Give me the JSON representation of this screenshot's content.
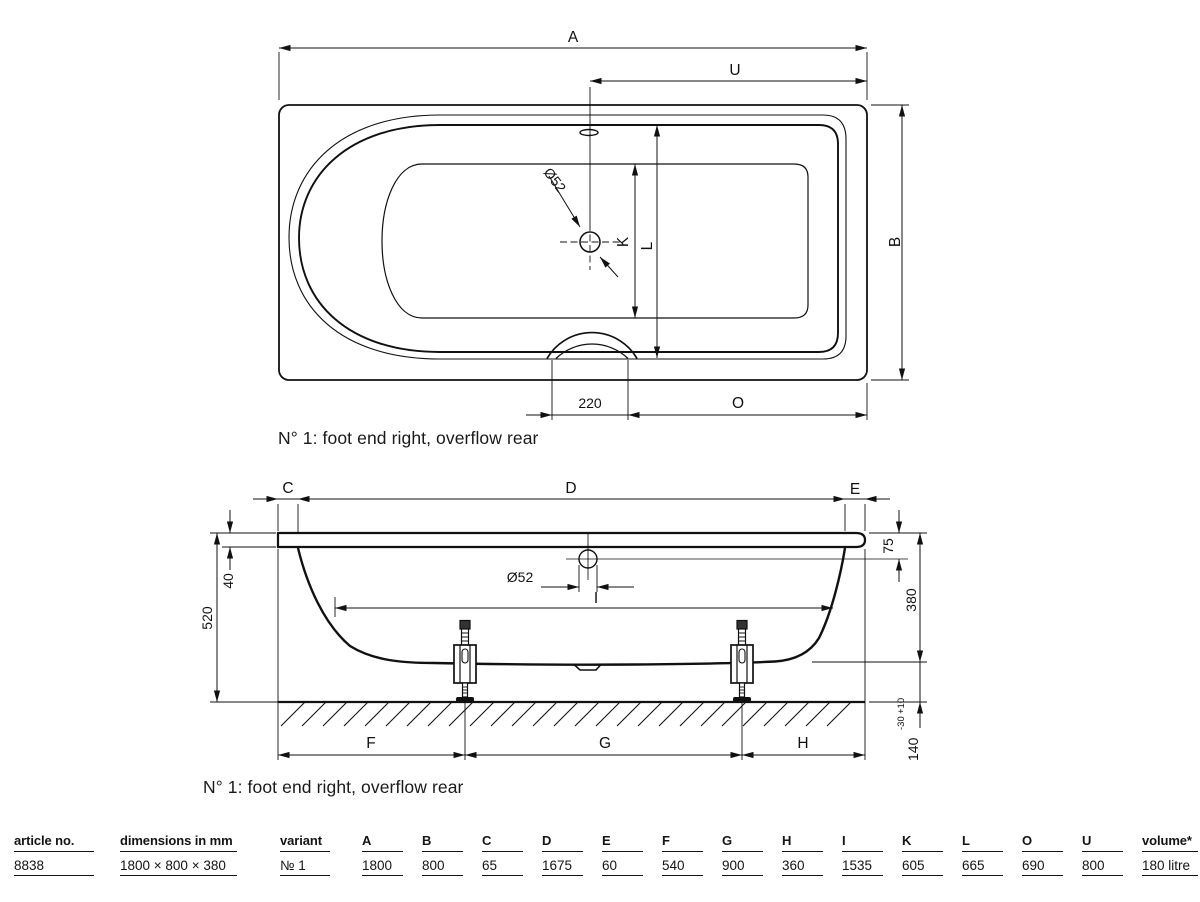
{
  "top_view": {
    "caption": "N° 1: foot end right, overflow rear",
    "dim_A": "A",
    "dim_U": "U",
    "dim_B": "B",
    "dim_K": "K",
    "dim_L": "L",
    "dim_O": "O",
    "drain_diameter": "Ø52",
    "grip_width": "220"
  },
  "side_view": {
    "caption": "N° 1: foot end right, overflow rear",
    "dim_C": "C",
    "dim_D": "D",
    "dim_E": "E",
    "dim_F": "F",
    "dim_G": "G",
    "dim_H": "H",
    "dim_I": "I",
    "rim_thickness": "40",
    "overall_height": "520",
    "drain_diameter": "Ø52",
    "rim_to_overflow": "75",
    "tub_depth": "380",
    "floor_clearance": "140",
    "clearance_tol_plus": "+10",
    "clearance_tol_minus": "-30"
  },
  "table": {
    "columns": [
      {
        "key": "article_no",
        "label": "article no.",
        "value": "8838",
        "type": "w1"
      },
      {
        "key": "dimensions",
        "label": "dimensions in mm",
        "value": "1800 × 800 × 380",
        "type": "w2"
      },
      {
        "key": "variant",
        "label": "variant",
        "value": "№ 1",
        "type": "w3"
      },
      {
        "key": "A",
        "label": "A",
        "value": "1800",
        "type": "dim"
      },
      {
        "key": "B",
        "label": "B",
        "value": "800",
        "type": "dim"
      },
      {
        "key": "C",
        "label": "C",
        "value": "65",
        "type": "dim"
      },
      {
        "key": "D",
        "label": "D",
        "value": "1675",
        "type": "dim"
      },
      {
        "key": "E",
        "label": "E",
        "value": "60",
        "type": "dim"
      },
      {
        "key": "F",
        "label": "F",
        "value": "540",
        "type": "dim"
      },
      {
        "key": "G",
        "label": "G",
        "value": "900",
        "type": "dim"
      },
      {
        "key": "H",
        "label": "H",
        "value": "360",
        "type": "dim"
      },
      {
        "key": "I",
        "label": "I",
        "value": "1535",
        "type": "dim"
      },
      {
        "key": "K",
        "label": "K",
        "value": "605",
        "type": "dim"
      },
      {
        "key": "L",
        "label": "L",
        "value": "665",
        "type": "dim"
      },
      {
        "key": "O",
        "label": "O",
        "value": "690",
        "type": "dim"
      },
      {
        "key": "U",
        "label": "U",
        "value": "800",
        "type": "dim"
      },
      {
        "key": "volume",
        "label": "volume*",
        "value": "180 litre",
        "type": "vol"
      }
    ]
  }
}
